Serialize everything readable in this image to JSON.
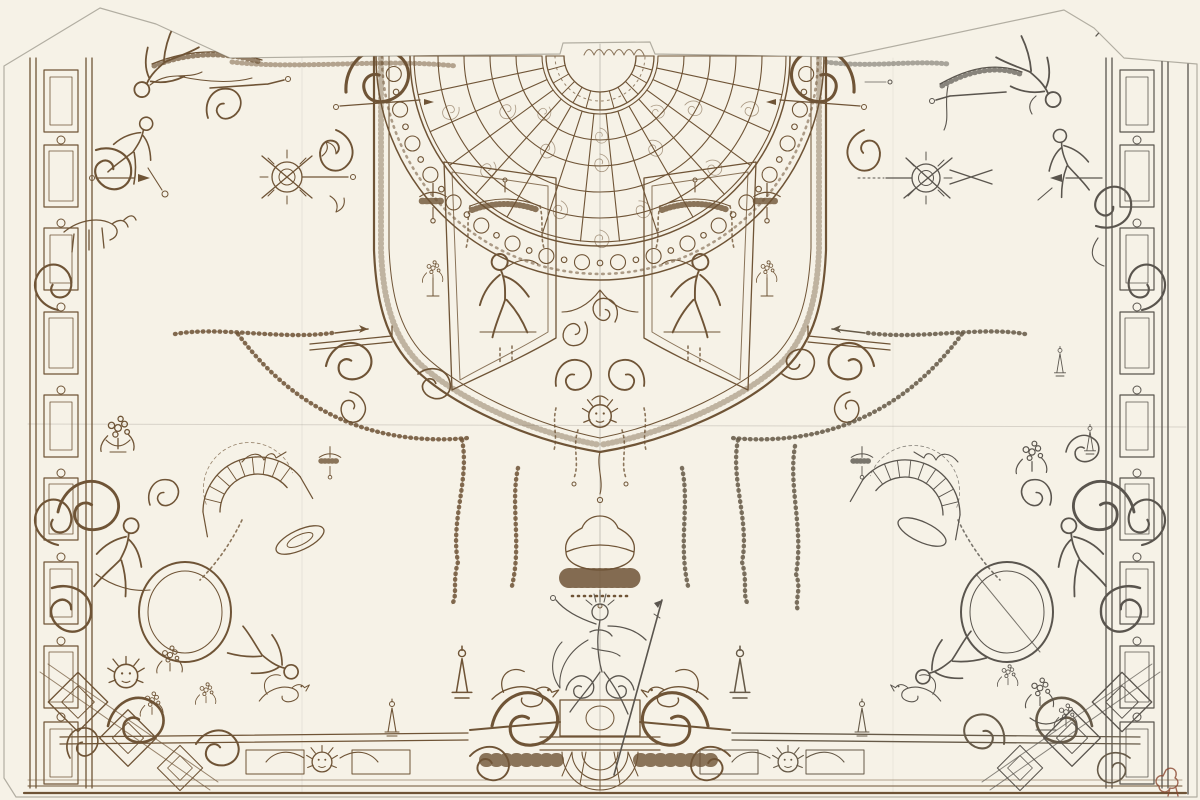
{
  "canvas": {
    "width": 1200,
    "height": 800,
    "background_color": "#f6f2e7"
  },
  "paper": {
    "color": "#d8d4c8",
    "top_margin_color": "#cdc9bd",
    "edge_color": "#b2aea2",
    "shape": "sheet with diagonally trimmed upper-left and upper-right corners and a small tab at top center",
    "description": "Old master sheet: ornamental design for one half/quarters of a decorative ceiling, pen and brown ink on the left, graphite on the right, squared in red chalk on the right half"
  },
  "media": {
    "brown_ink": "#6f5436",
    "graphite": "#5a554e",
    "red_chalk_grid": "#df8758",
    "red_chalk_accent": "#cb6c42",
    "bottom_rule": "#7b5d3c"
  },
  "grid": {
    "spacing_px": 37,
    "coverage": "right half of the sheet, from the central axis to the right border",
    "color": "#df8758"
  },
  "motifs": {
    "fan": {
      "description": "Large半 radial trellis fan (spider-web lattice) at top center with beaded ring border and scalloped rosette at its hub"
    },
    "cartouche": {
      "description": "Shield-shaped central cartouche with scrolled corners enclosing the fan and two lambrequin panels with seated figures"
    },
    "left_panel": {
      "description": "Left inner panel with fringed canopy, tassels and seated figure"
    },
    "right_panel": {
      "description": "Right inner panel with fringed canopy, tassels and seated figure"
    },
    "mask_pendant": {
      "description": "Mask face pendant with flanking C-scrolls below the cartouche"
    },
    "hanging_lamp": {
      "description": "Fringed hanging lamp / tasselled canopy suspended on the central axis"
    },
    "garlands": {
      "description": "Floral swag garlands and hanging husk tails flanking the central axis"
    },
    "trophy_left": {
      "description": "Sunburst-and-darts trophy medallion, upper left, in brown ink"
    },
    "trophy_right": {
      "description": "Sunburst-and-darts trophy medallion, upper right, in graphite"
    },
    "corner_tl": {
      "description": "Upper-left corner group: tumbling figures, trumpeter and goat over architectural border"
    },
    "corner_tr": {
      "description": "Upper-right corner group in graphite: tumbling and crouching figures over architectural border"
    },
    "corner_bl": {
      "description": "Lower-left cluster: oval medallion, trellis arch, reclining figures, ruffed mask, flowers, dragon and diamond panels"
    },
    "corner_br": {
      "description": "Lower-right cluster in graphite: oval medallion with crease line, trellis arch, figures, flower baskets and diamond panels"
    },
    "neptune": {
      "description": "Bottom-center seated male figure with spear on a scrolled pedestal flanked by winged dragons, over a shell and fringe apron"
    },
    "borders": {
      "description": "Ornamental border bands: panelled pilaster strips left and right, scrolled frieze with masks along the bottom"
    },
    "construction": {
      "description": "Graphite construction lines: vertical central axis, horizontal half-height line, faint vertical folds"
    },
    "collector_mark": {
      "description": "Small dark red collector's mark near the lower-right corner"
    }
  }
}
